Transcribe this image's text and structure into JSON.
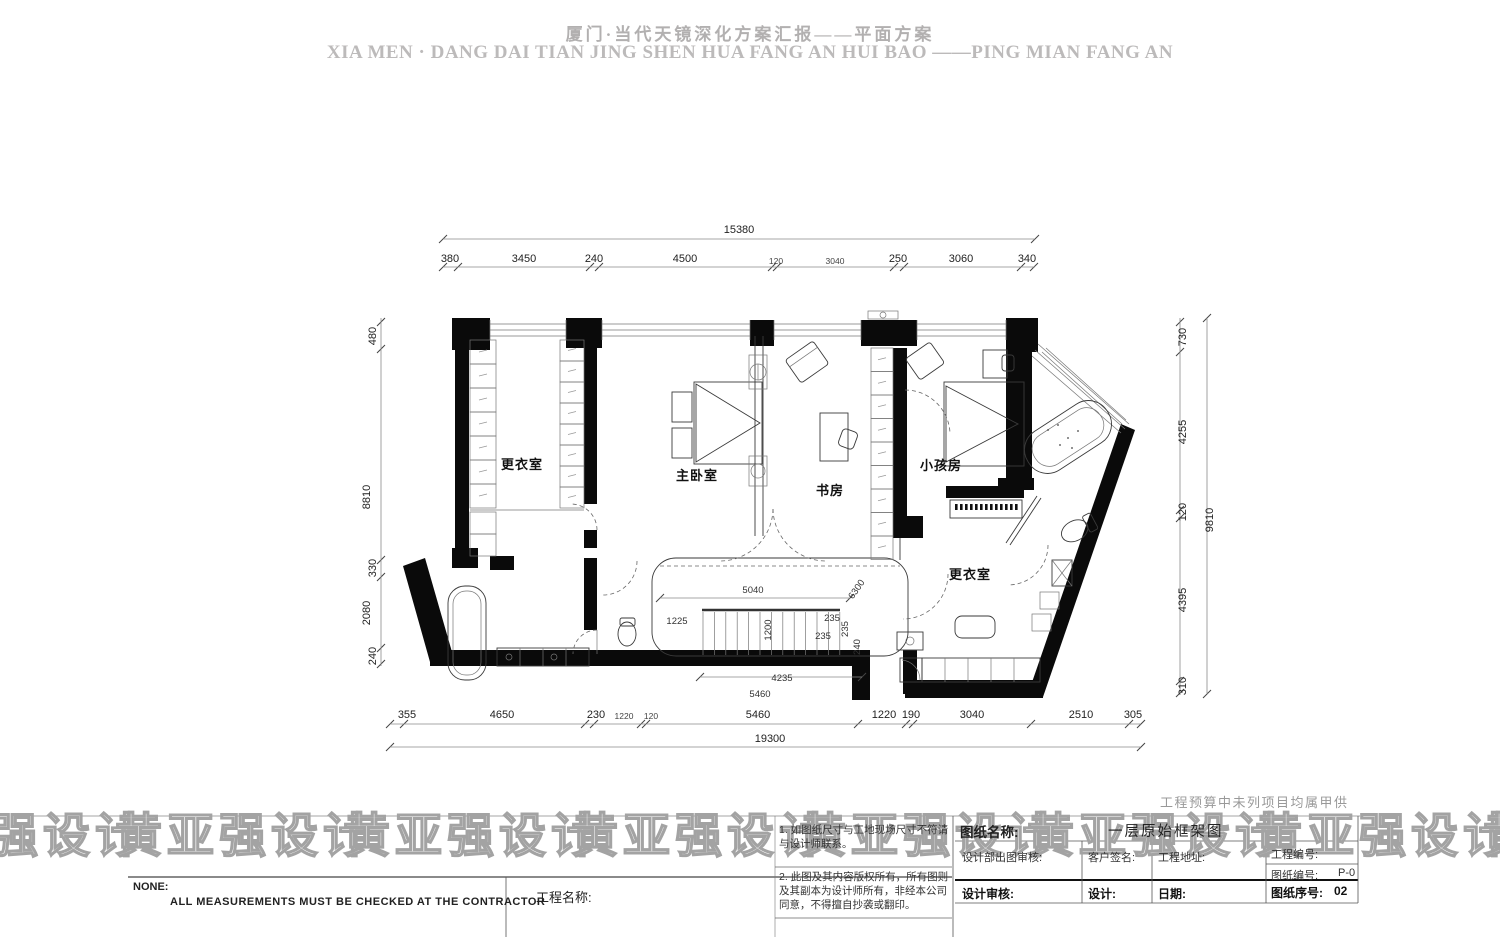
{
  "header": {
    "title_cn": "厦门·当代天镜深化方案汇报——平面方案",
    "title_en": "XIA MEN · DANG DAI TIAN JING  SHEN HUA FANG AN HUI BAO ——PING MIAN FANG AN"
  },
  "watermark": {
    "text": "黄亚强设计",
    "outline_color": "#a3a3a3"
  },
  "plan": {
    "rooms": {
      "dressing1": "更衣室",
      "master": "主卧室",
      "study": "书房",
      "kids": "小孩房",
      "dressing2": "更衣室"
    },
    "dims": {
      "top_overall": "15380",
      "top": [
        "380",
        "3450",
        "240",
        "4500",
        "120",
        "3040",
        "250",
        "3060",
        "340"
      ],
      "left": [
        "480",
        "8810",
        "330",
        "2080",
        "240"
      ],
      "right": [
        "730",
        "4255",
        "120",
        "4395",
        "310"
      ],
      "right_overall": "9810",
      "bottom": [
        "355",
        "4650",
        "230",
        "1220",
        "120",
        "5460",
        "1220",
        "190",
        "3040",
        "2510",
        "305"
      ],
      "bottom_overall": "19300",
      "inner": {
        "width": "5040",
        "left": "1225",
        "depth": "1200",
        "t1": "235",
        "t2": "235",
        "t3": "235",
        "t4": "240",
        "diag": "6300",
        "run": "4235",
        "total": "5460"
      }
    }
  },
  "footer": {
    "procurement_note": "工程预算中未列项目均属甲供",
    "scale_label": "NONE:",
    "note_en": "ALL  MEASUREMENTS  MUST  BE  CHECKED  AT  THE  CONTRACTOR",
    "project_name_label": "工程名称:",
    "notes": {
      "n1": "1.  如图纸尺寸与工地现场尺寸不符请与设计师联系。",
      "n2": "2.  此图及其内容版权所有，所有图则及其副本为设计师所有，非经本公司同意，不得擅自抄袭或翻印。"
    },
    "titleblock": {
      "drawing_name_label": "图纸名称:",
      "drawing_name_value": "一层原始框架图",
      "dept_review_label": "设计部出图审核:",
      "client_sign_label": "客户签名:",
      "address_label": "工程地址:",
      "project_no_label": "工程编号:",
      "drawing_no_label": "图纸编号:",
      "drawing_no_value": "P-0",
      "design_review_label": "设计审核:",
      "designer_label": "设计:",
      "date_label": "日期:",
      "serial_label": "图纸序号:",
      "serial_value": "02"
    }
  }
}
